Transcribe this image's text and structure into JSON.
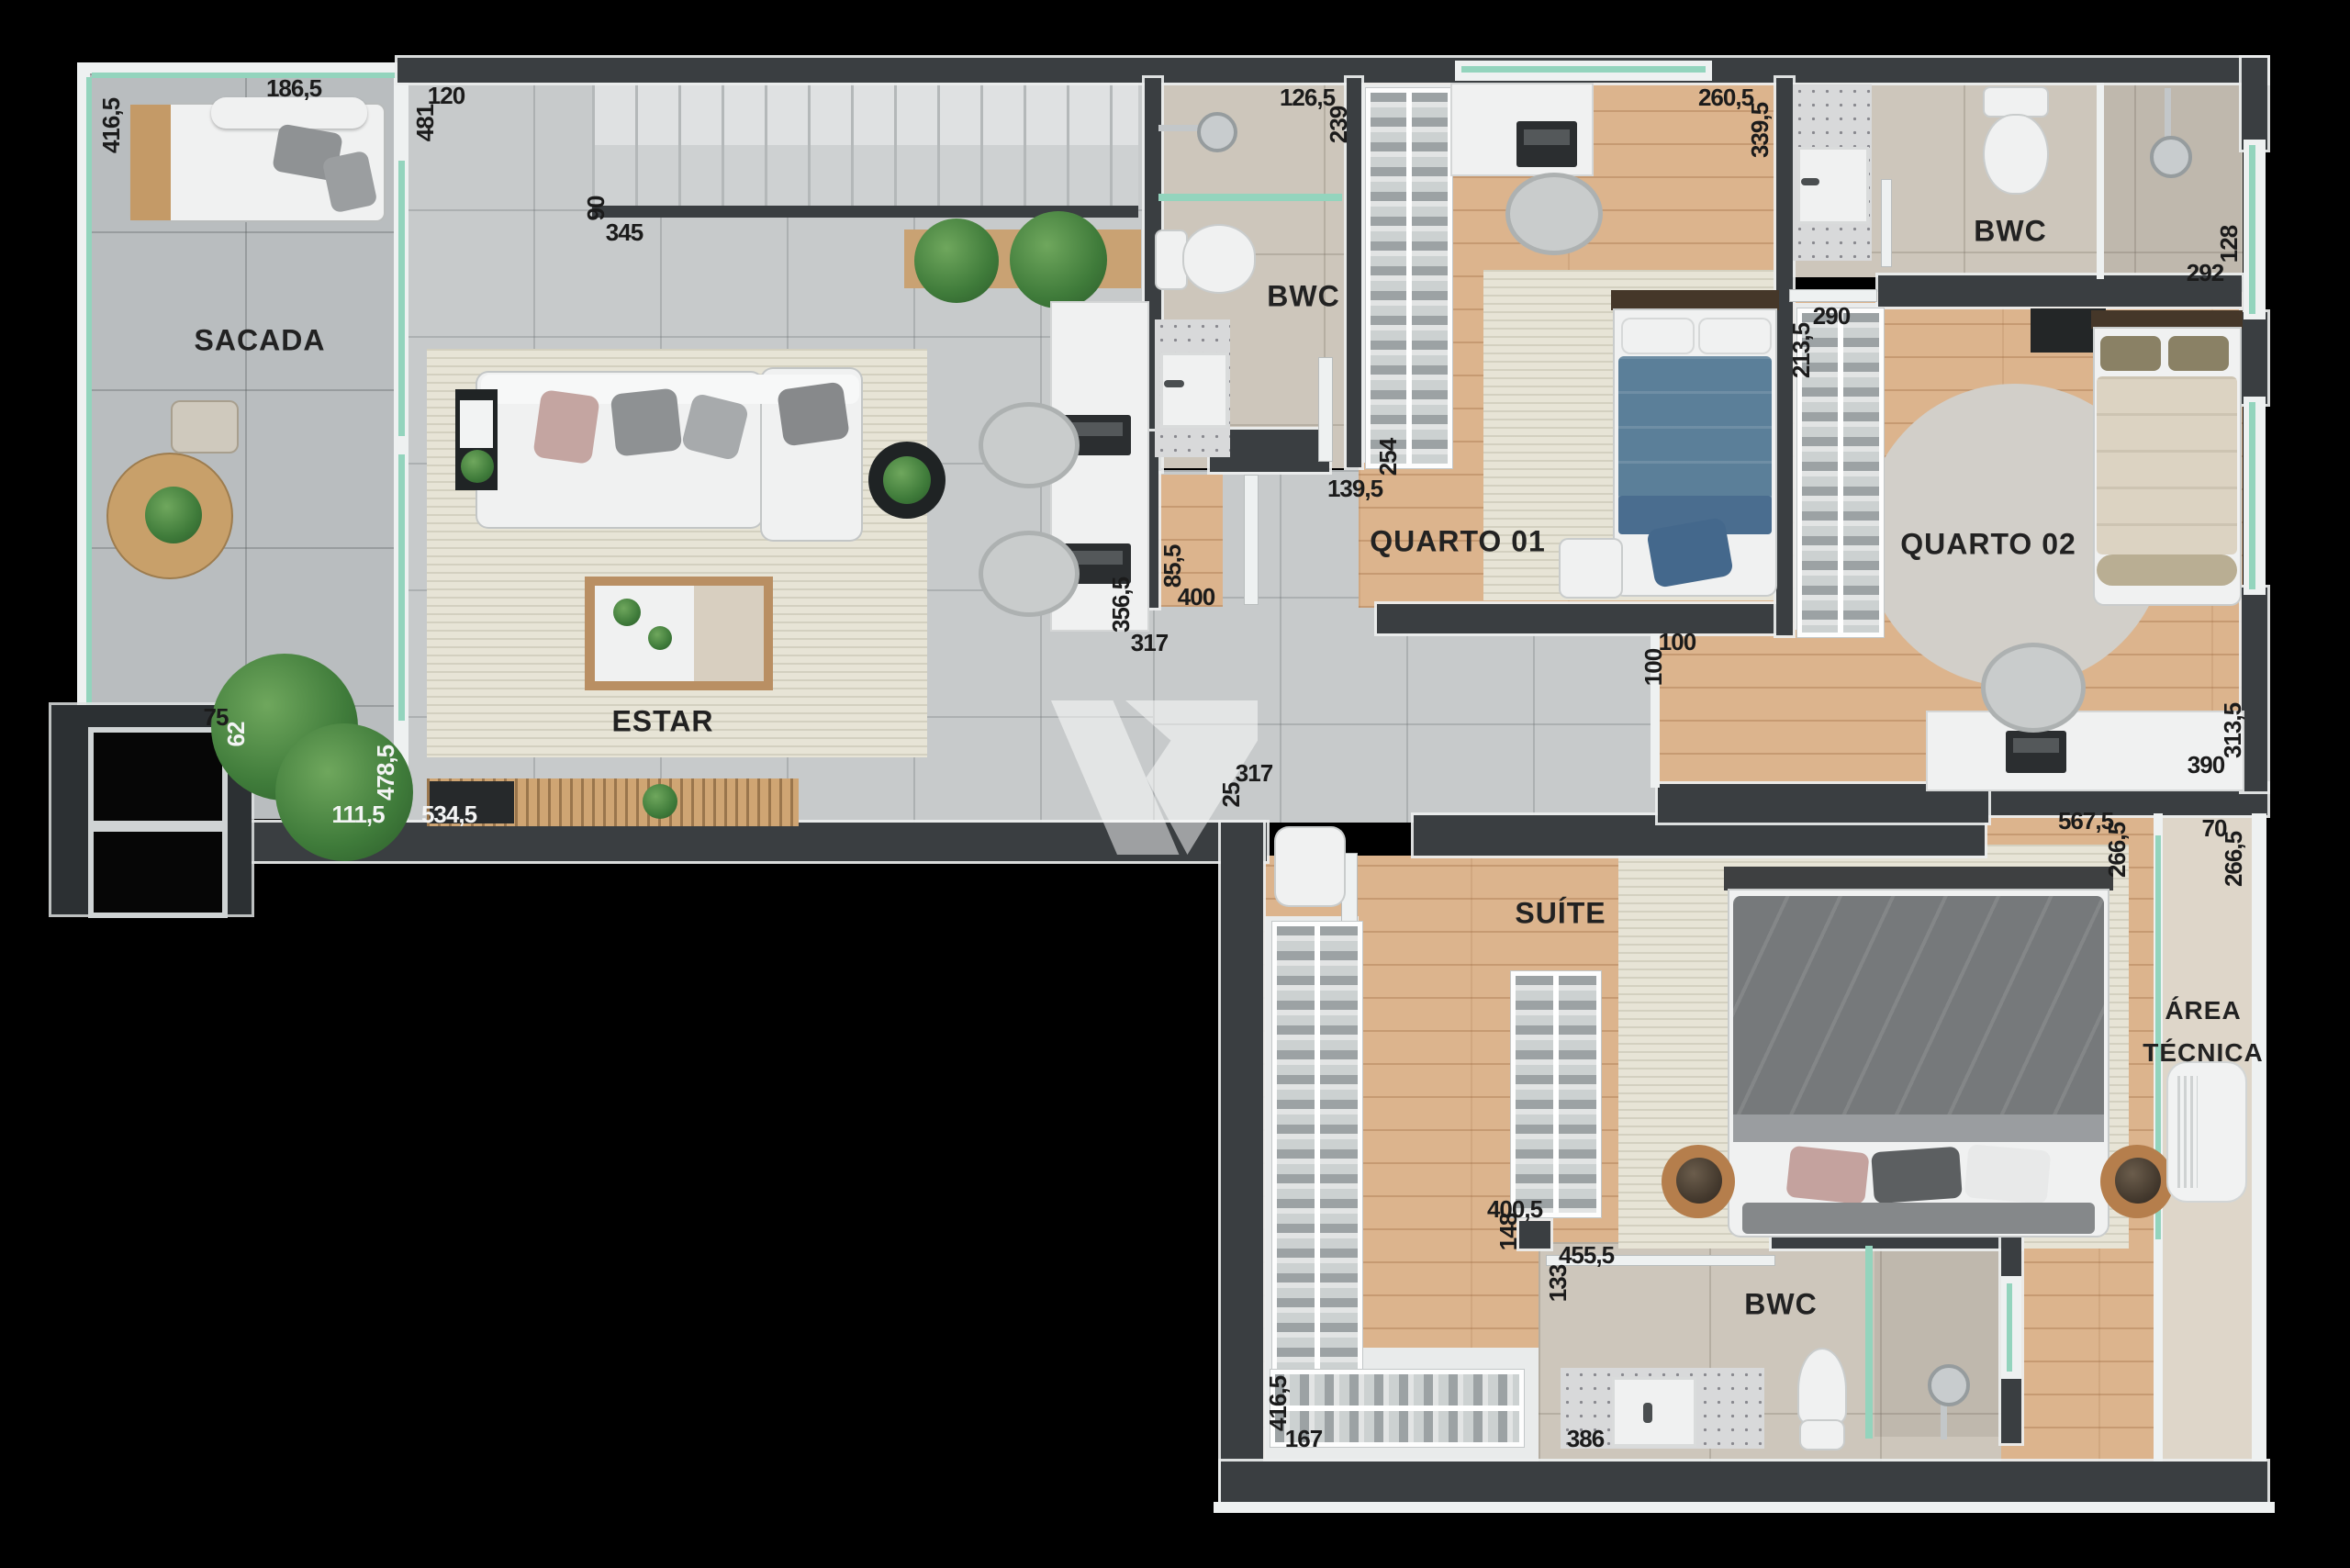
{
  "rooms": {
    "sacada": "SACADA",
    "estar": "ESTAR",
    "bwc1": "BWC",
    "quarto1": "QUARTO 01",
    "bwc2": "BWC",
    "quarto2": "QUARTO 02",
    "suite": "SUÍTE",
    "area_tecnica_l1": "ÁREA",
    "area_tecnica_l2": "TÉCNICA",
    "bwc3": "BWC"
  },
  "dims": [
    "186,5",
    "416,5",
    "120",
    "481",
    "90",
    "345",
    "126,5",
    "239",
    "260,5",
    "339,5",
    "292",
    "128",
    "290",
    "213,5",
    "254",
    "139,5",
    "85,5",
    "400",
    "356,5",
    "317",
    "100",
    "100",
    "313,5",
    "390",
    "567,5",
    "266,5",
    "70",
    "266,5",
    "75",
    "62",
    "478,5",
    "111,5",
    "534,5",
    "317",
    "25",
    "400,5",
    "148",
    "455,5",
    "133",
    "416,5",
    "167",
    "386"
  ]
}
